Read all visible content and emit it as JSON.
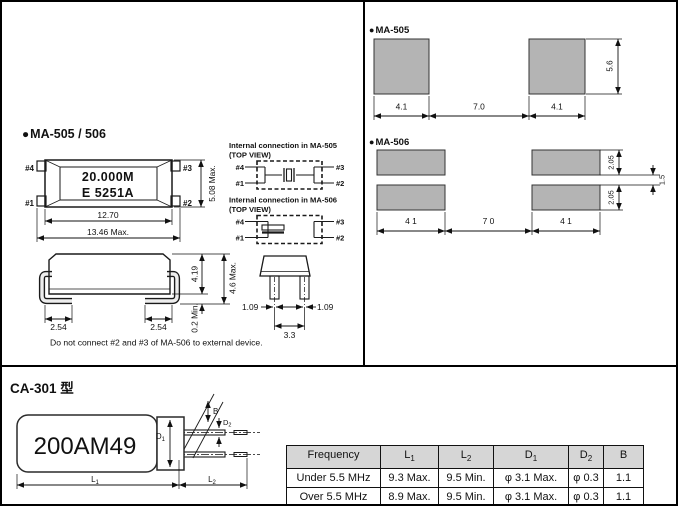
{
  "colors": {
    "line": "#111111",
    "pad_gray": "#b4b4b4",
    "panel_gray": "#d9d9d9",
    "table_header_bg": "#d6d6d6"
  },
  "sec_pkg": {
    "bullet": "●",
    "heading": "MA-505 / 506",
    "top_view": {
      "marking1": "20.000M",
      "marking2": "E 5251A",
      "pin4": "#4",
      "pin1": "#1",
      "pin3": "#3",
      "pin2": "#2",
      "dim_inner": "12.70",
      "dim_outer": "13.46 Max.",
      "dim_height": "5.08 Max."
    },
    "conn505": {
      "title": "Internal connection in MA-505",
      "subtitle": "(TOP VIEW)",
      "pin4": "#4",
      "pin1": "#1",
      "pin3": "#3",
      "pin2": "#2"
    },
    "conn506": {
      "title": "Internal connection in MA-506",
      "subtitle": "(TOP VIEW)",
      "pin4": "#4",
      "pin1": "#1",
      "pin3": "#3",
      "pin2": "#2"
    },
    "side_view": {
      "dim_body": "4.19",
      "dim_total": "4.6 Max.",
      "dim_standoff": "0.2 Min.",
      "dim_pad_left": "2.54",
      "dim_pad_right": "2.54"
    },
    "end_view": {
      "dim_lead_left": "1.09",
      "dim_lead_right": "1.09",
      "dim_span": "3.3"
    },
    "note": "Do not connect #2 and #3 of MA-506 to external device."
  },
  "sec_land505": {
    "bullet": "●",
    "heading": "MA-505",
    "dim_left": "4.1",
    "dim_gap": "7.0",
    "dim_right": "4.1",
    "dim_height": "5.6"
  },
  "sec_land506": {
    "bullet": "●",
    "heading": "MA-506",
    "dim_left": "4 1",
    "dim_gap": "7 0",
    "dim_right": "4 1",
    "dim_pad_top": "2.05",
    "dim_pad_bottom": "2.05",
    "dim_gap_v": "1.5"
  },
  "sec_ca301": {
    "heading": "CA-301 型",
    "marking": "200AM49",
    "labels": {
      "b": "B",
      "d1b": "D",
      "d1s": "1",
      "d2b": "D",
      "d2s": "2",
      "l1b": "L",
      "l1s": "1",
      "l2b": "L",
      "l2s": "2"
    },
    "table": {
      "headers": [
        {
          "base": "Frequency",
          "sub": ""
        },
        {
          "base": "L",
          "sub": "1"
        },
        {
          "base": "L",
          "sub": "2"
        },
        {
          "base": "D",
          "sub": "1"
        },
        {
          "base": "D",
          "sub": "2"
        },
        {
          "base": "B",
          "sub": ""
        }
      ],
      "rows": [
        [
          "Under 5.5 MHz",
          "9.3 Max.",
          "9.5 Min.",
          "φ 3.1 Max.",
          "φ 0.3",
          "1.1"
        ],
        [
          "Over 5.5 MHz",
          "8.9 Max.",
          "9.5 Min.",
          "φ 3.1 Max.",
          "φ 0.3",
          "1.1"
        ]
      ]
    }
  }
}
